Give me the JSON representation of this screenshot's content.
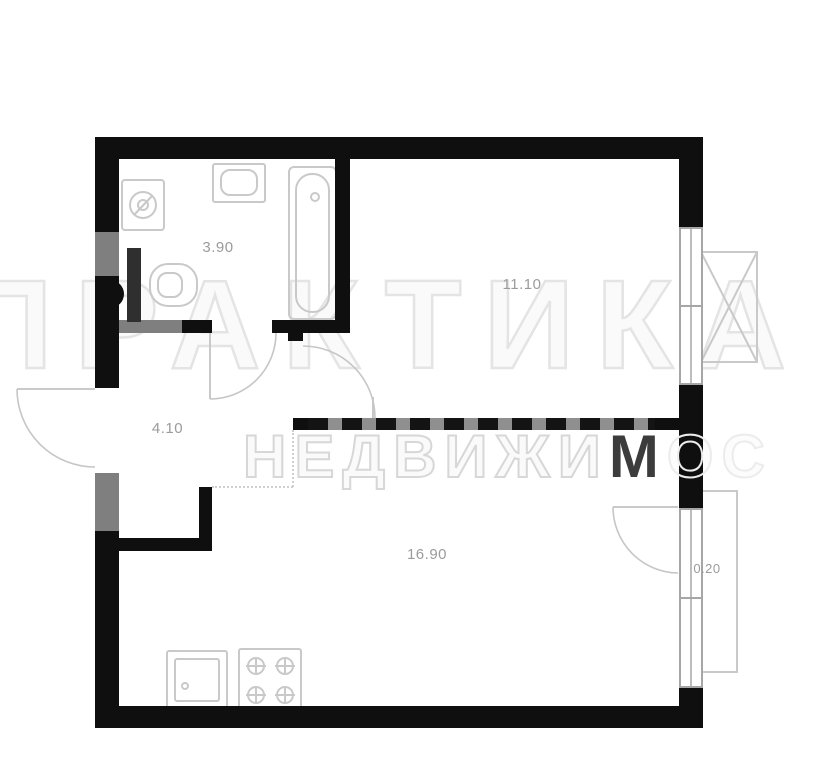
{
  "watermark": {
    "line1": "ПРАКТИКА",
    "line2_light": "НЕДВИЖИ",
    "line2_dark": "М",
    "line2_faint": "ОС"
  },
  "rooms": [
    {
      "name": "bathroom",
      "area": "3.90"
    },
    {
      "name": "room",
      "area": "11.10"
    },
    {
      "name": "hallway",
      "area": "4.10"
    },
    {
      "name": "kitchen-living-room",
      "area": "16.90"
    },
    {
      "name": "balcony",
      "area": "0.20"
    }
  ],
  "icons": [
    "washing-machine-icon",
    "bathroom-sink-icon",
    "bathtub-icon",
    "toilet-icon",
    "kitchen-sink-icon",
    "stove-icon",
    "ac-unit-icon",
    "window-icon",
    "door-swing-icon"
  ],
  "colors": {
    "wall": "#0f0f0f",
    "wall_secondary": "#7f7f7f",
    "fixture_outline": "#c9c9c9",
    "label": "#9b9b9b",
    "watermark_light": "#e4e4e4",
    "watermark_dark": "#3c3c3c",
    "background": "#ffffff"
  }
}
